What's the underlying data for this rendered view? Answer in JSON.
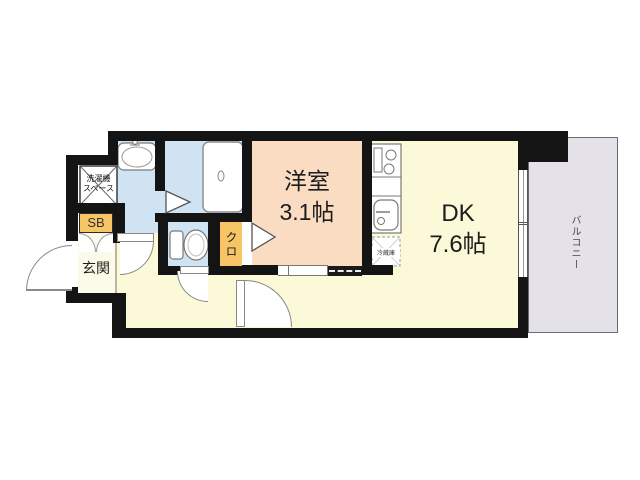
{
  "plan": {
    "type": "apartment-floorplan",
    "rooms": {
      "yoshitsu": {
        "name": "洋室",
        "size": "3.1帖"
      },
      "dk": {
        "name": "DK",
        "size": "7.6帖"
      },
      "genkan": {
        "label": "玄関"
      },
      "closet": {
        "label": "クロ"
      },
      "shoebox": {
        "label": "SB"
      },
      "laundry": {
        "line1": "洗濯機",
        "line2": "スペース"
      },
      "balcony": {
        "label": "バルコニー"
      },
      "fridge": {
        "label": "冷蔵庫"
      }
    },
    "colors": {
      "wall": "#141414",
      "wet_rooms": "#cfe3f3",
      "bedroom": "#fadcc2",
      "living_hall": "#fbf9d8",
      "genkan_floor": "#fcfbea",
      "storage_orange": "#f7c466",
      "balcony_gray": "#e4e2e8",
      "background": "#ffffff"
    }
  }
}
